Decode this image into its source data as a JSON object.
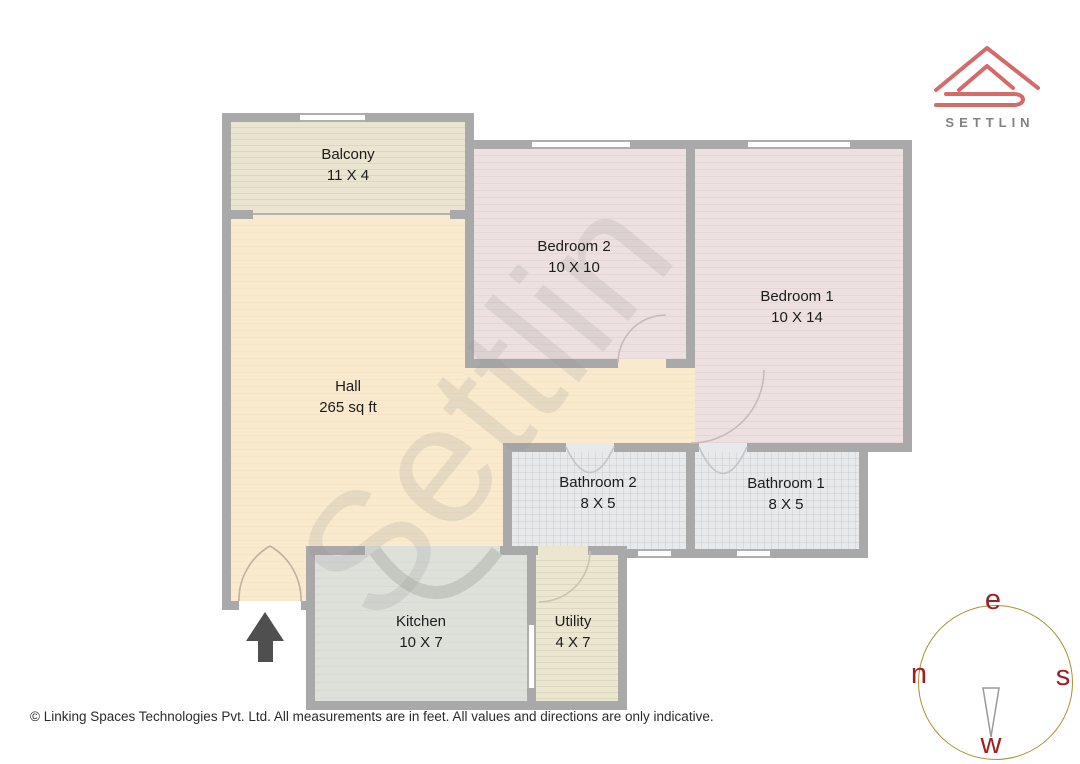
{
  "brand": {
    "logo_text": "SETTLIN",
    "logo_color": "#d46a6a",
    "logo_text_color": "#828282"
  },
  "watermark": {
    "text": "Settlin"
  },
  "plan": {
    "wall_color": "#a9a9a9"
  },
  "rooms": [
    {
      "key": "balcony",
      "name": "Balcony",
      "dims": "11 X 4",
      "floor_color": "#e9e5d0"
    },
    {
      "key": "hall",
      "name": "Hall",
      "dims": "265 sq ft",
      "floor_color": "#f9e9cd"
    },
    {
      "key": "bedroom2",
      "name": "Bedroom 2",
      "dims": "10 X 10",
      "floor_color": "#ece0e0"
    },
    {
      "key": "bedroom1",
      "name": "Bedroom 1",
      "dims": "10 X 14",
      "floor_color": "#ece0e0"
    },
    {
      "key": "bathroom2",
      "name": "Bathroom 2",
      "dims": "8 X 5",
      "floor_color": "#e7e9eb"
    },
    {
      "key": "bathroom1",
      "name": "Bathroom 1",
      "dims": "8 X 5",
      "floor_color": "#e7e9eb"
    },
    {
      "key": "kitchen",
      "name": "Kitchen",
      "dims": "10 X 7",
      "floor_color": "#dde1d9"
    },
    {
      "key": "utility",
      "name": "Utility",
      "dims": "4 X 7",
      "floor_color": "#eae6d0"
    }
  ],
  "compass": {
    "top": "e",
    "left": "n",
    "right": "s",
    "bottom": "w",
    "ring_color": "#b08f2e",
    "letter_color": "#9c2121"
  },
  "footer": {
    "text": "© Linking Spaces Technologies Pvt. Ltd. All measurements are in feet. All values and directions are only indicative."
  }
}
